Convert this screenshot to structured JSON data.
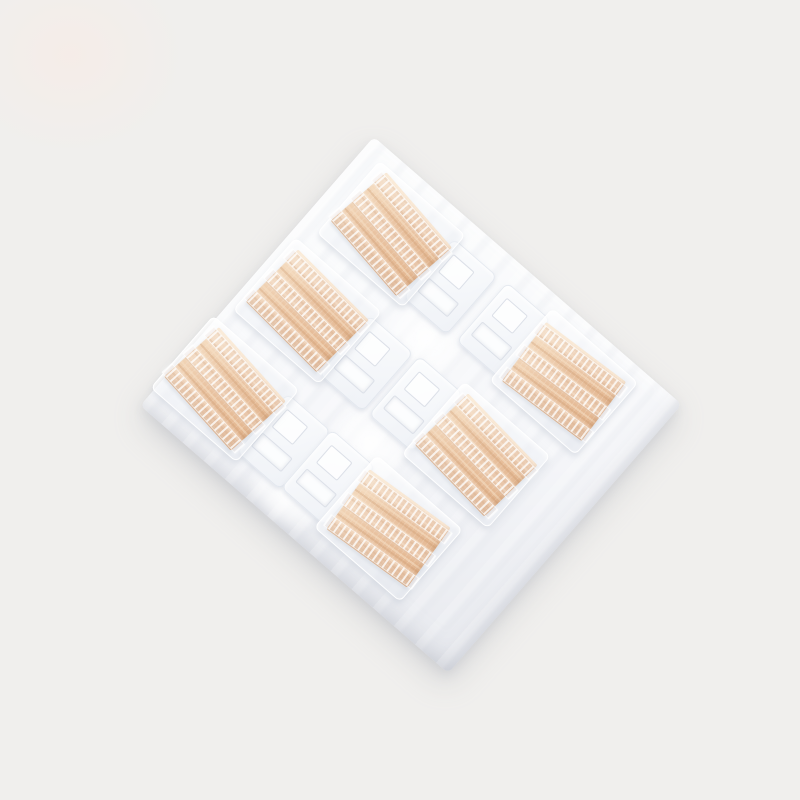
{
  "scene": {
    "type": "product-photo",
    "description": "Tilted transparent blister pack on a plain light-grey backdrop holding six beige fabric adhesive patches arranged in two columns of three; each patch is crossed by three white perforated ladder strips, and moulded clear pocket tails with small rectangular cavities sit between the columns",
    "patch_count": 6,
    "grid": {
      "columns": 2,
      "rows": 3
    },
    "colors": {
      "backdrop": "#f0efed",
      "pack-bright": "#fbfcfd",
      "pack-base": "#f5f6f9",
      "pack-shade": "#e7e9ee",
      "patch-base": "#e9c3a1",
      "patch-light": "#f6dfc4",
      "patch-deep": "#e2b48d",
      "ladder-rung": "#ffffff",
      "mold-line": "#dce0e8"
    },
    "pack": {
      "x": 207,
      "y": 227,
      "w": 408,
      "h": 356,
      "rotation_deg": 41,
      "corner_radius": 6
    },
    "pocket_size": {
      "w": 114,
      "h": 96
    },
    "patch_size": {
      "w": 100,
      "h": 74
    },
    "cells": [
      {
        "id": "cell-1",
        "x": 20,
        "y": 14,
        "tail": "right",
        "patch_rotation_deg": 8
      },
      {
        "id": "cell-2",
        "x": 7,
        "y": 127,
        "tail": "right",
        "patch_rotation_deg": 4
      },
      {
        "id": "cell-3",
        "x": -4,
        "y": 240,
        "tail": "right",
        "patch_rotation_deg": 7
      },
      {
        "id": "cell-4",
        "x": 247,
        "y": 12,
        "tail": "left",
        "patch_rotation_deg": -4
      },
      {
        "id": "cell-5",
        "x": 229,
        "y": 125,
        "tail": "left",
        "patch_rotation_deg": 5
      },
      {
        "id": "cell-6",
        "x": 211,
        "y": 238,
        "tail": "left",
        "patch_rotation_deg": -5
      }
    ],
    "ladder_offsets_px": [
      3,
      31,
      59
    ],
    "highlights": [
      {
        "x": 128,
        "y": 82,
        "w": 90,
        "h": 72
      },
      {
        "x": 150,
        "y": 192,
        "w": 96,
        "h": 82
      },
      {
        "x": 126,
        "y": 296,
        "w": 86,
        "h": 62
      },
      {
        "x": 196,
        "y": 146,
        "w": 72,
        "h": 60
      },
      {
        "x": 178,
        "y": 258,
        "w": 82,
        "h": 68
      }
    ]
  }
}
